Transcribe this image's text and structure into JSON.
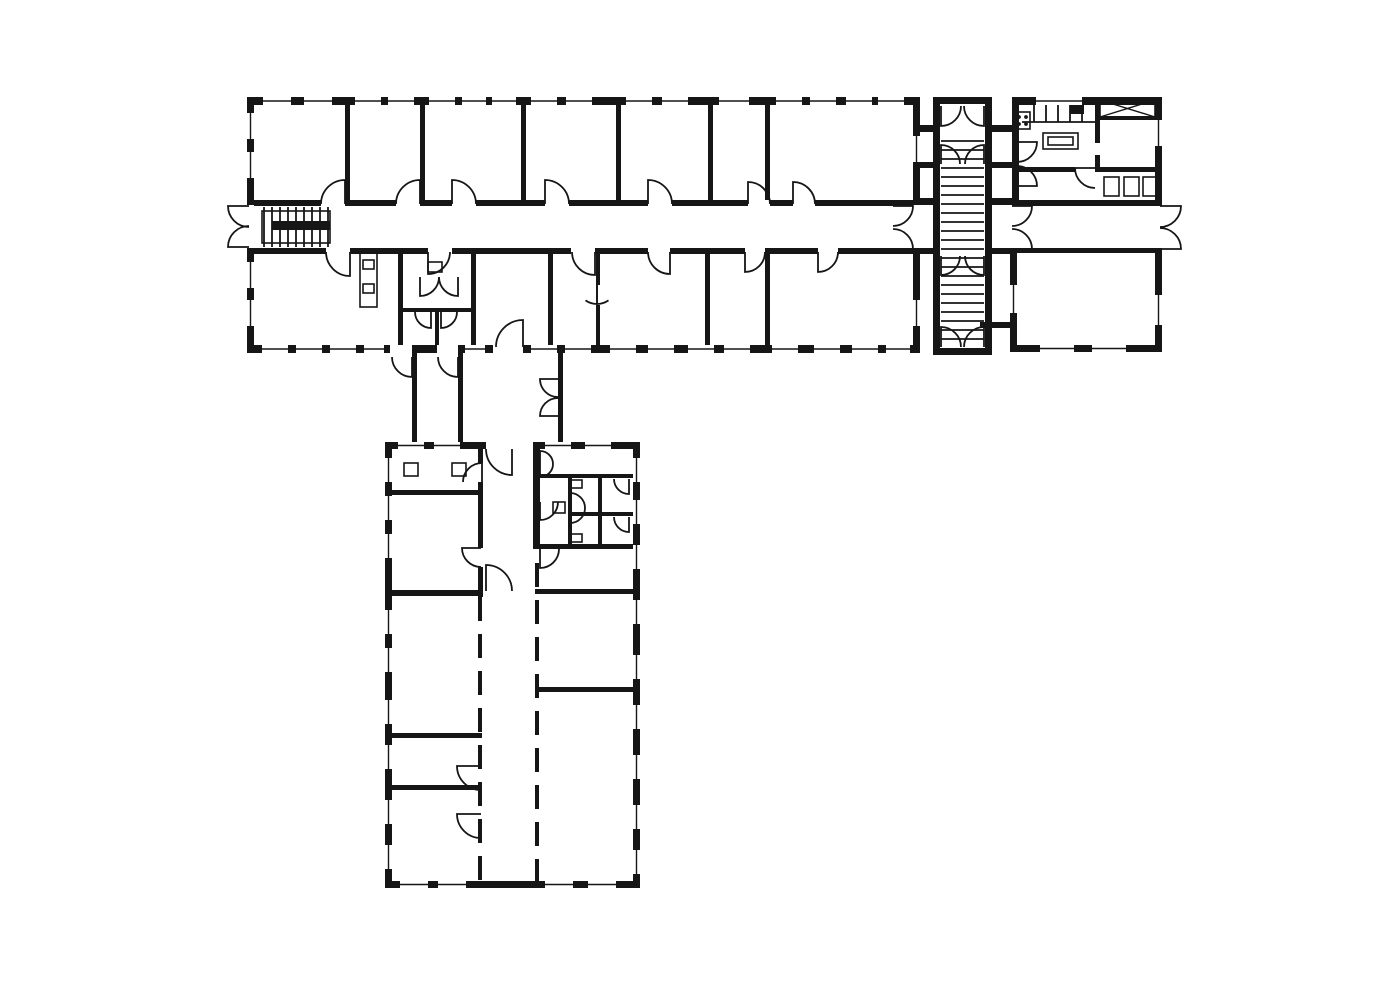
{
  "meta": {
    "title": "Architectural floor plan — L-shaped building with two wings, stair tower and kitchen block",
    "canvas_w": 1400,
    "canvas_h": 984,
    "ink": "#161616",
    "paper": "#ffffff"
  },
  "plan": {
    "walls": [
      [
        247,
        97,
        673,
        8
      ],
      [
        247,
        97,
        7,
        108
      ],
      [
        247,
        248,
        7,
        105
      ],
      [
        913,
        97,
        7,
        108
      ],
      [
        913,
        248,
        7,
        105
      ],
      [
        247,
        345,
        143,
        8
      ],
      [
        412,
        345,
        25,
        8
      ],
      [
        458,
        345,
        35,
        8
      ],
      [
        523,
        345,
        397,
        8
      ],
      [
        254,
        200,
        67,
        6
      ],
      [
        345,
        200,
        51,
        6
      ],
      [
        420,
        200,
        32,
        6
      ],
      [
        476,
        200,
        69,
        6
      ],
      [
        569,
        200,
        79,
        6
      ],
      [
        672,
        200,
        76,
        6
      ],
      [
        770,
        200,
        23,
        6
      ],
      [
        815,
        200,
        98,
        6
      ],
      [
        254,
        248,
        72,
        6
      ],
      [
        350,
        248,
        78,
        6
      ],
      [
        452,
        248,
        119,
        6
      ],
      [
        595,
        248,
        53,
        6
      ],
      [
        670,
        248,
        75,
        6
      ],
      [
        765,
        248,
        53,
        6
      ],
      [
        838,
        248,
        75,
        6
      ],
      [
        345,
        105,
        5,
        95
      ],
      [
        420,
        105,
        5,
        95
      ],
      [
        521,
        105,
        5,
        95
      ],
      [
        616,
        105,
        5,
        95
      ],
      [
        708,
        105,
        5,
        95
      ],
      [
        765,
        105,
        5,
        95
      ],
      [
        398,
        254,
        5,
        91
      ],
      [
        471,
        254,
        5,
        91
      ],
      [
        548,
        254,
        5,
        91
      ],
      [
        596,
        254,
        4,
        31
      ],
      [
        596,
        305,
        4,
        40
      ],
      [
        705,
        254,
        5,
        91
      ],
      [
        765,
        254,
        5,
        91
      ],
      [
        400,
        308,
        73,
        4
      ],
      [
        435,
        310,
        4,
        35
      ],
      [
        412,
        353,
        5,
        89
      ],
      [
        458,
        353,
        5,
        89
      ],
      [
        558,
        353,
        5,
        89
      ],
      [
        385,
        442,
        101,
        7
      ],
      [
        533,
        442,
        107,
        7
      ],
      [
        385,
        442,
        7,
        446
      ],
      [
        633,
        442,
        7,
        446
      ],
      [
        385,
        881,
        255,
        7
      ],
      [
        392,
        490,
        90,
        5
      ],
      [
        392,
        590,
        90,
        6
      ],
      [
        392,
        733,
        90,
        5
      ],
      [
        392,
        785,
        90,
        5
      ],
      [
        478,
        449,
        5,
        14
      ],
      [
        478,
        482,
        5,
        66
      ],
      [
        478,
        567,
        5,
        30
      ],
      [
        533,
        448,
        7,
        101
      ],
      [
        540,
        474,
        93,
        4
      ],
      [
        568,
        512,
        65,
        4
      ],
      [
        533,
        544,
        100,
        5
      ],
      [
        568,
        478,
        4,
        66
      ],
      [
        598,
        478,
        4,
        66
      ],
      [
        535,
        589,
        98,
        5
      ],
      [
        535,
        687,
        98,
        5
      ],
      [
        933,
        97,
        7,
        258
      ],
      [
        985,
        97,
        7,
        258
      ],
      [
        933,
        97,
        59,
        7
      ],
      [
        933,
        348,
        59,
        7
      ],
      [
        920,
        125,
        13,
        7
      ],
      [
        920,
        162,
        13,
        6
      ],
      [
        920,
        198,
        13,
        7
      ],
      [
        920,
        248,
        13,
        6
      ],
      [
        992,
        125,
        20,
        7
      ],
      [
        992,
        162,
        20,
        6
      ],
      [
        992,
        198,
        20,
        7
      ],
      [
        992,
        248,
        20,
        6
      ],
      [
        980,
        322,
        33,
        6
      ],
      [
        1012,
        97,
        150,
        8
      ],
      [
        1012,
        97,
        7,
        108
      ],
      [
        1155,
        97,
        7,
        108
      ],
      [
        1155,
        248,
        7,
        104
      ],
      [
        1012,
        200,
        150,
        6
      ],
      [
        1012,
        248,
        150,
        5
      ],
      [
        1017,
        167,
        58,
        5
      ],
      [
        1095,
        167,
        65,
        5
      ],
      [
        1095,
        103,
        5,
        40
      ],
      [
        1095,
        155,
        5,
        17
      ],
      [
        1100,
        116,
        55,
        4
      ],
      [
        1010,
        253,
        7,
        99
      ],
      [
        1010,
        345,
        152,
        7
      ]
    ],
    "windows_h": [
      [
        263,
        97,
        28,
        8
      ],
      [
        304,
        97,
        28,
        8
      ],
      [
        355,
        97,
        26,
        8
      ],
      [
        388,
        97,
        26,
        8
      ],
      [
        429,
        97,
        26,
        8
      ],
      [
        462,
        97,
        24,
        8
      ],
      [
        492,
        97,
        24,
        8
      ],
      [
        531,
        97,
        26,
        8
      ],
      [
        566,
        97,
        26,
        8
      ],
      [
        626,
        97,
        26,
        8
      ],
      [
        662,
        97,
        26,
        8
      ],
      [
        719,
        97,
        30,
        8
      ],
      [
        776,
        97,
        26,
        8
      ],
      [
        810,
        97,
        26,
        8
      ],
      [
        846,
        97,
        26,
        8
      ],
      [
        878,
        97,
        26,
        8
      ],
      [
        262,
        345,
        26,
        8
      ],
      [
        296,
        345,
        26,
        8
      ],
      [
        330,
        345,
        26,
        8
      ],
      [
        364,
        345,
        20,
        8
      ],
      [
        465,
        345,
        20,
        8
      ],
      [
        531,
        345,
        26,
        8
      ],
      [
        565,
        345,
        26,
        8
      ],
      [
        610,
        345,
        26,
        8
      ],
      [
        648,
        345,
        26,
        8
      ],
      [
        688,
        345,
        26,
        8
      ],
      [
        724,
        345,
        26,
        8
      ],
      [
        772,
        345,
        26,
        8
      ],
      [
        814,
        345,
        26,
        8
      ],
      [
        852,
        345,
        26,
        8
      ],
      [
        886,
        345,
        24,
        8
      ],
      [
        400,
        881,
        28,
        7
      ],
      [
        438,
        881,
        28,
        7
      ],
      [
        545,
        881,
        28,
        7
      ],
      [
        588,
        881,
        28,
        7
      ],
      [
        398,
        442,
        26,
        7
      ],
      [
        434,
        442,
        26,
        7
      ],
      [
        545,
        442,
        26,
        7
      ],
      [
        585,
        442,
        26,
        7
      ],
      [
        1036,
        97,
        46,
        8
      ],
      [
        1040,
        345,
        34,
        7
      ],
      [
        1092,
        345,
        34,
        7
      ]
    ],
    "windows_v": [
      [
        247,
        113,
        26,
        7
      ],
      [
        247,
        152,
        26,
        7
      ],
      [
        247,
        262,
        26,
        7
      ],
      [
        247,
        300,
        26,
        7
      ],
      [
        913,
        136,
        26,
        7
      ],
      [
        913,
        300,
        26,
        7
      ],
      [
        385,
        458,
        24,
        7
      ],
      [
        385,
        496,
        24,
        7
      ],
      [
        385,
        534,
        24,
        7
      ],
      [
        385,
        610,
        24,
        7
      ],
      [
        385,
        648,
        24,
        7
      ],
      [
        385,
        700,
        24,
        7
      ],
      [
        385,
        745,
        24,
        7
      ],
      [
        385,
        800,
        24,
        7
      ],
      [
        385,
        845,
        24,
        7
      ],
      [
        633,
        458,
        24,
        7
      ],
      [
        633,
        500,
        24,
        7
      ],
      [
        633,
        545,
        24,
        7
      ],
      [
        633,
        600,
        24,
        7
      ],
      [
        633,
        655,
        24,
        7
      ],
      [
        633,
        705,
        24,
        7
      ],
      [
        633,
        755,
        24,
        7
      ],
      [
        633,
        805,
        24,
        7
      ],
      [
        633,
        850,
        24,
        7
      ],
      [
        1155,
        120,
        26,
        7
      ],
      [
        1155,
        295,
        30,
        7
      ],
      [
        1010,
        285,
        28,
        7
      ]
    ],
    "doors": [
      [
        345,
        204,
        24,
        270,
        180
      ],
      [
        420,
        204,
        24,
        270,
        180
      ],
      [
        452,
        204,
        24,
        270,
        0
      ],
      [
        545,
        204,
        24,
        270,
        0
      ],
      [
        648,
        204,
        24,
        270,
        0
      ],
      [
        748,
        204,
        22,
        270,
        0
      ],
      [
        793,
        204,
        22,
        270,
        0
      ],
      [
        350,
        252,
        24,
        90,
        180
      ],
      [
        428,
        252,
        22,
        90,
        0
      ],
      [
        595,
        252,
        23,
        90,
        180
      ],
      [
        670,
        252,
        22,
        90,
        180
      ],
      [
        745,
        252,
        20,
        90,
        0
      ],
      [
        818,
        252,
        20,
        90,
        0
      ],
      [
        523,
        347,
        27,
        270,
        180
      ],
      [
        420,
        277,
        19,
        90,
        0
      ],
      [
        458,
        277,
        19,
        90,
        180
      ],
      [
        431,
        312,
        16,
        90,
        180
      ],
      [
        441,
        312,
        16,
        90,
        0
      ],
      [
        412,
        357,
        20,
        90,
        180
      ],
      [
        458,
        357,
        20,
        90,
        180
      ],
      [
        558,
        379,
        18,
        180,
        90
      ],
      [
        558,
        416,
        18,
        180,
        270
      ],
      [
        249,
        206,
        21,
        180,
        90
      ],
      [
        249,
        247,
        21,
        180,
        270
      ],
      [
        893,
        206,
        20,
        0,
        90
      ],
      [
        893,
        249,
        20,
        0,
        270
      ],
      [
        1012,
        206,
        20,
        0,
        90
      ],
      [
        1012,
        249,
        20,
        0,
        270
      ],
      [
        1160,
        206,
        21,
        0,
        90
      ],
      [
        1160,
        249,
        21,
        0,
        270
      ],
      [
        941,
        106,
        20,
        90,
        0
      ],
      [
        984,
        106,
        20,
        90,
        180
      ],
      [
        941,
        164,
        19,
        270,
        0
      ],
      [
        984,
        164,
        19,
        270,
        180
      ],
      [
        941,
        256,
        19,
        90,
        0
      ],
      [
        984,
        256,
        19,
        90,
        180
      ],
      [
        941,
        347,
        20,
        270,
        0
      ],
      [
        984,
        347,
        20,
        270,
        180
      ],
      [
        512,
        449,
        26,
        90,
        180
      ],
      [
        482,
        482,
        19,
        270,
        180
      ],
      [
        481,
        548,
        19,
        180,
        90
      ],
      [
        486,
        591,
        26,
        270,
        0
      ],
      [
        481,
        766,
        24,
        180,
        90
      ],
      [
        481,
        814,
        24,
        180,
        90
      ],
      [
        540,
        464,
        13,
        270,
        0
      ],
      [
        540,
        464,
        13,
        90,
        0
      ],
      [
        540,
        502,
        18,
        90,
        0
      ],
      [
        570,
        508,
        15,
        270,
        0
      ],
      [
        570,
        508,
        15,
        90,
        0
      ],
      [
        629,
        479,
        15,
        90,
        180
      ],
      [
        629,
        517,
        15,
        90,
        180
      ],
      [
        540,
        549,
        19,
        90,
        0
      ],
      [
        1017,
        142,
        20,
        0,
        90
      ],
      [
        1017,
        186,
        20,
        0,
        270
      ],
      [
        1095,
        168,
        20,
        180,
        90
      ],
      [
        597,
        284,
        20,
        90,
        55
      ],
      [
        597,
        284,
        20,
        90,
        125
      ]
    ],
    "dashed_walls": [
      [
        480,
        597,
        480,
        881
      ],
      [
        537,
        563,
        537,
        881
      ]
    ],
    "vlines": [
      [
        264,
        207,
        247
      ],
      [
        272,
        207,
        247
      ],
      [
        280,
        207,
        247
      ],
      [
        288,
        207,
        247
      ],
      [
        296,
        207,
        247
      ],
      [
        304,
        207,
        247
      ],
      [
        312,
        207,
        247
      ],
      [
        320,
        207,
        247
      ],
      [
        328,
        207,
        247
      ],
      [
        1034,
        105,
        122
      ],
      [
        1046,
        105,
        122
      ],
      [
        1058,
        105,
        122
      ],
      [
        1070,
        105,
        122
      ],
      [
        1082,
        105,
        122
      ]
    ],
    "hlines": [
      [
        141,
        941,
        984
      ],
      [
        150,
        941,
        984
      ],
      [
        159,
        941,
        984
      ],
      [
        168,
        941,
        984
      ],
      [
        177,
        941,
        984
      ],
      [
        186,
        941,
        984
      ],
      [
        195,
        941,
        984
      ],
      [
        204,
        941,
        984
      ],
      [
        213,
        941,
        984
      ],
      [
        222,
        941,
        984
      ],
      [
        231,
        941,
        984
      ],
      [
        240,
        941,
        984
      ],
      [
        249,
        941,
        984
      ],
      [
        258,
        941,
        984
      ],
      [
        267,
        941,
        984
      ],
      [
        276,
        941,
        984
      ],
      [
        285,
        941,
        984
      ],
      [
        294,
        941,
        984
      ],
      [
        303,
        941,
        984
      ],
      [
        312,
        941,
        984
      ],
      [
        321,
        941,
        984
      ],
      [
        330,
        941,
        984
      ],
      [
        339,
        941,
        984
      ],
      [
        122,
        1022,
        1095
      ]
    ],
    "diagonals": [
      [
        1100,
        100,
        1155,
        117
      ],
      [
        1155,
        100,
        1100,
        117
      ]
    ],
    "outlines": [
      [
        "stair-outline",
        262,
        211,
        68,
        32
      ],
      [
        "shelf-unit",
        360,
        253,
        17,
        54
      ],
      [
        "shelf-box",
        363,
        260,
        11,
        9
      ],
      [
        "shelf-box",
        363,
        284,
        11,
        9
      ],
      [
        "wash-basin",
        428,
        262,
        14,
        10
      ],
      [
        "column",
        404,
        463,
        14,
        13
      ],
      [
        "column",
        452,
        463,
        14,
        13
      ],
      [
        "toilet",
        571,
        480,
        11,
        8
      ],
      [
        "toilet",
        571,
        534,
        11,
        8
      ],
      [
        "wash-basin",
        553,
        502,
        12,
        11
      ],
      [
        "stove",
        1015,
        112,
        15,
        17
      ],
      [
        "table",
        1043,
        133,
        35,
        16
      ],
      [
        "table-inner",
        1048,
        137,
        25,
        8
      ],
      [
        "cabinet",
        1104,
        177,
        15,
        19
      ],
      [
        "cabinet",
        1124,
        177,
        15,
        19
      ],
      [
        "cabinet",
        1143,
        177,
        15,
        19
      ],
      [
        "shaft-box",
        1100,
        100,
        55,
        17
      ]
    ],
    "filled_rects": [
      [
        "stair-landing-bar",
        272,
        221,
        58,
        9
      ],
      [
        "kitchen-sink-block",
        1070,
        105,
        14,
        9
      ]
    ],
    "dots": [
      [
        1019,
        117
      ],
      [
        1026,
        117
      ],
      [
        1019,
        124
      ],
      [
        1026,
        124
      ]
    ]
  }
}
